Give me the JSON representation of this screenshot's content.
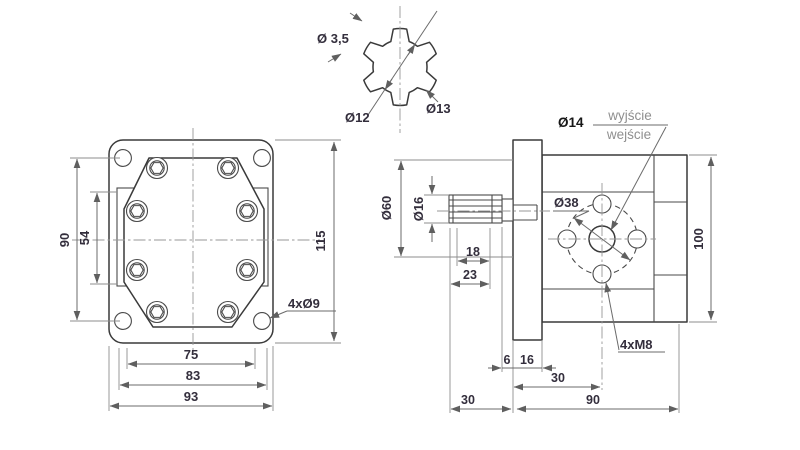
{
  "drawing_type": "gear pump technical drawing",
  "colors": {
    "background": "#ffffff",
    "object_line": "#3a3a3a",
    "dimension_line": "#6b6b6b",
    "centerline": "#979797",
    "dimension_text": "#332e3c",
    "muted_text": "#8f8f8f"
  },
  "spline_detail": {
    "tooth_width": "Ø 3,5",
    "root_diameter": "Ø12",
    "outer_diameter": "Ø13"
  },
  "front_view": {
    "bolt_spacing_vertical": "90",
    "body_height": "54",
    "height_overall": "115",
    "corner_holes": "4xØ9",
    "bolt_spacing_horizontal": "75",
    "body_width": "83",
    "width_overall": "93"
  },
  "side_view": {
    "port_diameter": "Ø14",
    "port_outlet": "wyjście",
    "port_inlet": "wejście",
    "flange_pilot_diameter": "Ø60",
    "shaft_diameter": "Ø16",
    "bolt_circle_diameter": "Ø38",
    "mounting_threads": "4xM8",
    "spline_length": "18",
    "shaft_length": "23",
    "spline_to_flange_gap": "6",
    "flange_thickness": "16",
    "flange_to_port_center": "30",
    "shaft_protrusion": "30",
    "body_length": "90",
    "body_height": "100"
  }
}
